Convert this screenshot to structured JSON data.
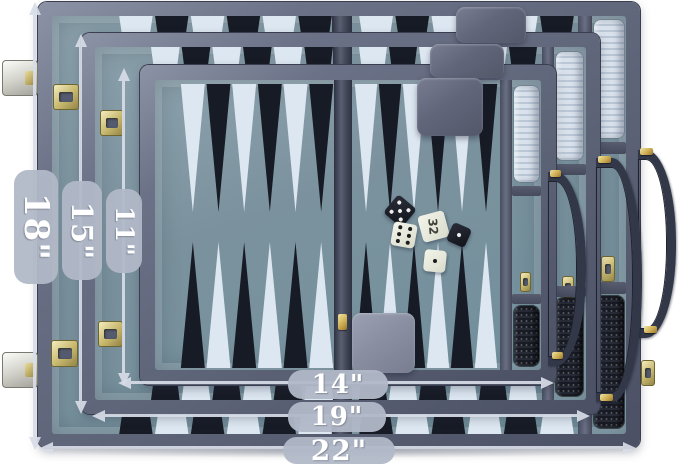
{
  "scene": {
    "description": "Open navy-blue backgammon briefcase set shown in three nested sizes with white dimension arrows and size labels"
  },
  "labels": {
    "height_large": "18\"",
    "height_medium": "15\"",
    "height_small": "11\"",
    "width_small": "14\"",
    "width_medium": "19\"",
    "width_large": "22\""
  },
  "dice": [
    {
      "name": "black-die-five",
      "pips": 5,
      "style": "black"
    },
    {
      "name": "doubling-cube",
      "face": "32",
      "style": "white"
    },
    {
      "name": "white-die-six",
      "pips": 6,
      "style": "white"
    },
    {
      "name": "black-die-one",
      "pips": 1,
      "style": "black"
    },
    {
      "name": "white-die-one",
      "pips": 1,
      "style": "white"
    }
  ],
  "colors": {
    "case_rim": "#666c80",
    "felt": "#7f96a2",
    "point_light": "#dde7f1",
    "point_dark": "#171b25",
    "checker_white": "#cdd8e5",
    "checker_black": "#14161d",
    "cup": "#5f6579",
    "brass": "#c9bc77",
    "arrow": "#d8dde8",
    "label_bg": "#b1b8c7",
    "label_text": "#ffffff",
    "handle": "#343950"
  }
}
